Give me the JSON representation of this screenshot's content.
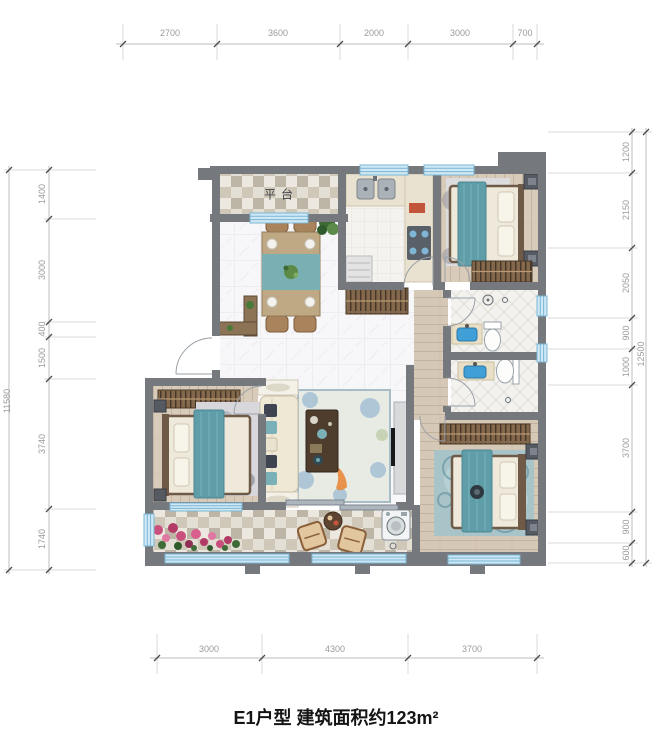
{
  "title": "E1户型 建筑面积约123m²",
  "plan": {
    "platform_label": "平台",
    "colors": {
      "wall": "#75797e",
      "window_glass": "#cfe8f5",
      "window_frame": "#7ab6d4",
      "accent_teal": "#5f9da8",
      "wood_floor": "#d9cbba",
      "marble_floor": "#f7f7f9",
      "checker_dark": "#bdb5a6",
      "checker_light": "#ece8df",
      "wardrobe_wood": "#83684c",
      "dim_text": "#9b9b9b"
    }
  },
  "dimensions": {
    "top": [
      "2700",
      "3600",
      "2000",
      "3000",
      "700"
    ],
    "bottom": [
      "3000",
      "4300",
      "3700"
    ],
    "left": [
      "1400",
      "3000",
      "400",
      "1500",
      "3740",
      "1740"
    ],
    "left_overall": "11580",
    "right": [
      "1200",
      "2150",
      "2050",
      "900",
      "1000",
      "3700",
      "900",
      "600"
    ],
    "right_overall": "12500"
  }
}
